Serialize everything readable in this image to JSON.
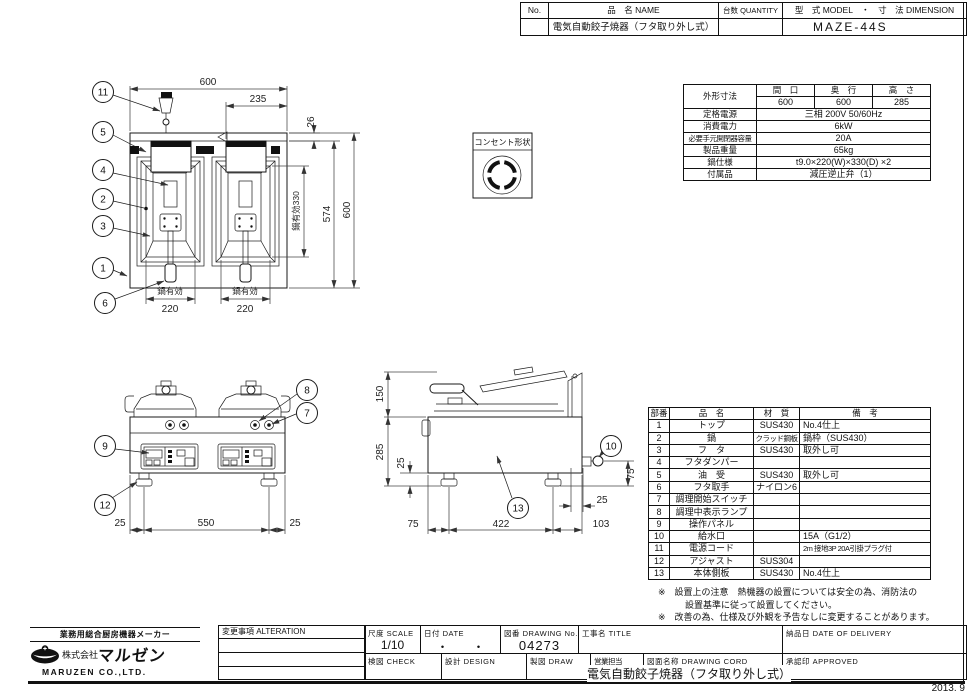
{
  "header_table": {
    "no_label": "No.",
    "name_label": "品　名 NAME",
    "qty_label": "台数 QUANTITY",
    "model_label": "型　式 MODEL　・　寸　法 DIMENSION",
    "product_name": "電気自動餃子焼器（フタ取り外し式）",
    "model_value": "MAZE-44S"
  },
  "spec_table": {
    "dim_label": "外形寸法",
    "col_width": "間　口",
    "col_depth": "奥　行",
    "col_height": "高　さ",
    "val_width": "600",
    "val_depth": "600",
    "val_height": "285",
    "rows": [
      {
        "label": "定格電源",
        "value": "三相 200V 50/60Hz"
      },
      {
        "label": "消費電力",
        "value": "6kW"
      },
      {
        "label": "必要手元開閉器容量",
        "value": "20A"
      },
      {
        "label": "製品重量",
        "value": "65kg"
      },
      {
        "label": "鍋仕様",
        "value": "t9.0×220(W)×330(D) ×2"
      },
      {
        "label": "付属品",
        "value": "減圧逆止弁（1）"
      }
    ]
  },
  "parts_table": {
    "headers": [
      "部番",
      "品　名",
      "材　質",
      "備　考"
    ],
    "rows": [
      {
        "no": "1",
        "name": "トップ",
        "material": "SUS430",
        "note": "No.4仕上"
      },
      {
        "no": "2",
        "name": "鍋",
        "material": "クラッド鋼板",
        "note": "鍋枠（SUS430）"
      },
      {
        "no": "3",
        "name": "フ　タ",
        "material": "SUS430",
        "note": "取外し可"
      },
      {
        "no": "4",
        "name": "フタダンパー",
        "material": "",
        "note": ""
      },
      {
        "no": "5",
        "name": "油　受",
        "material": "SUS430",
        "note": "取外し可"
      },
      {
        "no": "6",
        "name": "フタ取手",
        "material": "ナイロン6",
        "note": ""
      },
      {
        "no": "7",
        "name": "調理開始スイッチ",
        "material": "",
        "note": ""
      },
      {
        "no": "8",
        "name": "調理中表示ランプ",
        "material": "",
        "note": ""
      },
      {
        "no": "9",
        "name": "操作パネル",
        "material": "",
        "note": ""
      },
      {
        "no": "10",
        "name": "給水口",
        "material": "",
        "note": "15A（G1/2）"
      },
      {
        "no": "11",
        "name": "電源コード",
        "material": "",
        "note": "2m 接地3P 20A引掛プラグ付"
      },
      {
        "no": "12",
        "name": "アジャスト",
        "material": "SUS304",
        "note": ""
      },
      {
        "no": "13",
        "name": "本体側板",
        "material": "SUS430",
        "note": "No.4仕上"
      }
    ]
  },
  "notes": {
    "line1": "※　設置上の注意　熱機器の設置については安全の為、消防法の",
    "line2": "設置基準に従って設置してください。",
    "line3": "※　改善の為、仕様及び外観を予告なしに変更することがあります。"
  },
  "outlet": {
    "label": "コンセント形状"
  },
  "dims": {
    "plan": {
      "width": "600",
      "lid": "235",
      "band": "26",
      "inner": "574",
      "depth": "600",
      "pan_depth": "鍋有効330",
      "pan_label": "鍋有効",
      "pan_width": "220"
    },
    "front": {
      "m1": "25",
      "span": "550",
      "m2": "25"
    },
    "side": {
      "h_top": "150",
      "h_body": "285",
      "h_foot": "25",
      "h_inlet": "75",
      "inlet_off": "25",
      "m_front": "75",
      "span": "422",
      "m_rear": "103"
    }
  },
  "balloons": {
    "1": "1",
    "2": "2",
    "3": "3",
    "4": "4",
    "5": "5",
    "6": "6",
    "7": "7",
    "8": "8",
    "9": "9",
    "10": "10",
    "11": "11",
    "12": "12",
    "13": "13"
  },
  "titleblock": {
    "alteration_label": "変更事項 ALTERATION",
    "scale_label": "尺度 SCALE",
    "scale_value": "1/10",
    "date_label": "日付 DATE",
    "date_value": "・　　・",
    "dwgno_label": "図番 DRAWING No.",
    "dwgno_value": "04273",
    "title_label": "工事名 TITLE",
    "check_label": "検図 CHECK",
    "design_label": "設計 DESIGN",
    "draw_label": "製図 DRAW",
    "charge_label": "営業担当 CHARGE",
    "name_label": "図面名称 DRAWING CORD",
    "name_value": "電気自動餃子焼器（フタ取り外し式）",
    "delivery_label": "納品日 DATE OF DELIVERY",
    "approved_label": "承認印 APPROVED"
  },
  "company": {
    "tagline": "業務用総合厨房機器メーカー",
    "prefix": "株式会社",
    "brand": "マルゼン",
    "english": "MARUZEN CO.,LTD."
  },
  "stamp": "2013. 9"
}
